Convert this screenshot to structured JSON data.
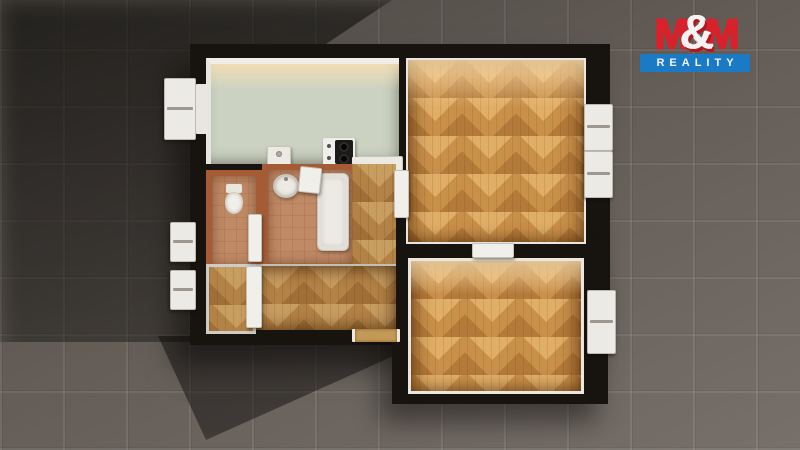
{
  "brand": {
    "name_left": "M",
    "ampersand": "&",
    "name_right": "M",
    "subtitle": "REALITY",
    "red": "#d7222b",
    "blue": "#1a7ac6",
    "white": "#f5f4f2"
  },
  "scene": {
    "kind": "3D top-down render of an apartment floor plan on dark paving tiles",
    "colors": {
      "background_tile": "#6b645d",
      "wall": "#17130e",
      "parquet": "#c9904a",
      "parquet_highlight": "#e0ae67",
      "kitchen_floor": "#cbd2c2",
      "bathroom_wall": "#a55c36",
      "bathroom_floor": "#c08a66",
      "fixture_white": "#edeae4",
      "entry_door_wood": "#c39a55"
    },
    "rooms": [
      {
        "id": "kitchen",
        "floor": "green linoleum"
      },
      {
        "id": "living-room",
        "floor": "herringbone parquet"
      },
      {
        "id": "bedroom",
        "floor": "herringbone parquet"
      },
      {
        "id": "bathroom",
        "floor": "terracotta tile"
      },
      {
        "id": "wc",
        "floor": "terracotta tile"
      },
      {
        "id": "hallway",
        "floor": "herringbone parquet"
      },
      {
        "id": "closet",
        "floor": "herringbone parquet"
      }
    ]
  }
}
